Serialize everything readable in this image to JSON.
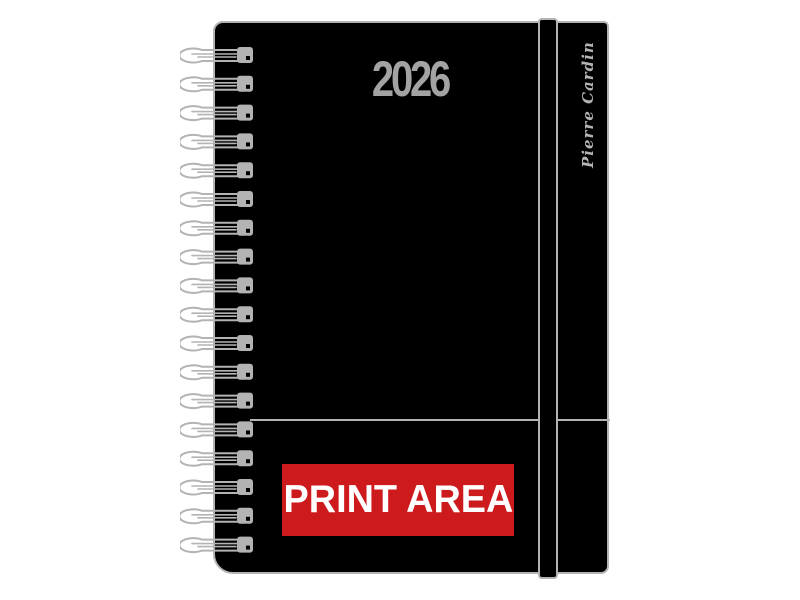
{
  "diary": {
    "year": "2026",
    "brand": "Pierre Cardin",
    "print_area_label": "PRINT AREA"
  },
  "spiral": {
    "loop_count": 18
  },
  "colors": {
    "cover": "#000000",
    "outline_gray": "#b3b3b3",
    "year_text_gray": "#a3a3a3",
    "print_area_background": "#cd1a1d",
    "print_area_text": "#ffffff"
  }
}
